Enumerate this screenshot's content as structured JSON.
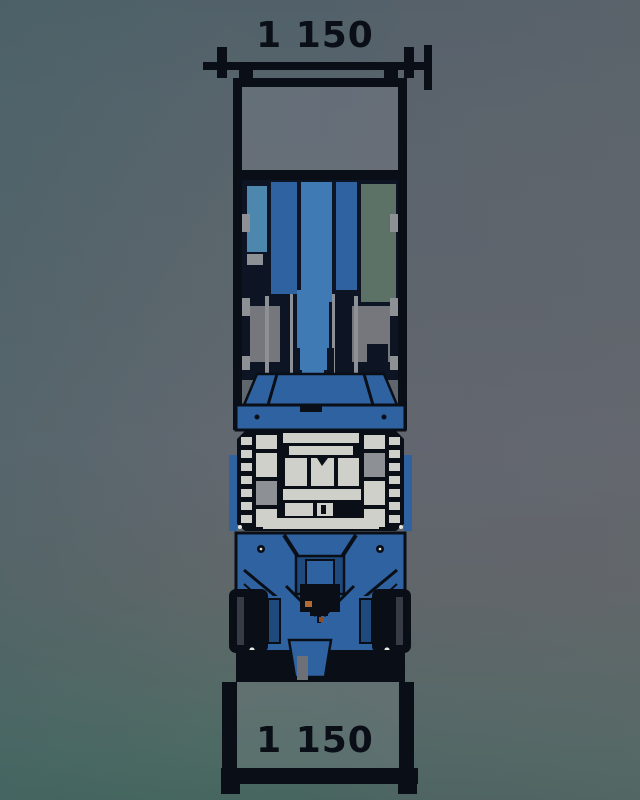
{
  "dimensions": {
    "top": {
      "value": "1 150"
    },
    "bottom": {
      "value": "1 150"
    }
  },
  "colors": {
    "line_dark": "#0a0e16",
    "inner_navy": "#0d1424",
    "machine_blue": "#2e62a0",
    "machine_blue_bright": "#3f7ab5",
    "machine_blue_deep": "#1f4a7d",
    "machine_blue_pale": "#4e87ad",
    "panel_green_gray": "#5d7266",
    "metal_light": "#cfd0ca",
    "metal_gray": "#8d9095",
    "window_gray": "#75777d",
    "accent_orange": "#b06a33",
    "accent_orange_dark": "#8d4e2a",
    "screw_white": "#e6e7e3",
    "bg_teal_left": "#4d666d",
    "bg_purple_right": "#5d6069",
    "bg_teal_bottom": "#486661"
  }
}
